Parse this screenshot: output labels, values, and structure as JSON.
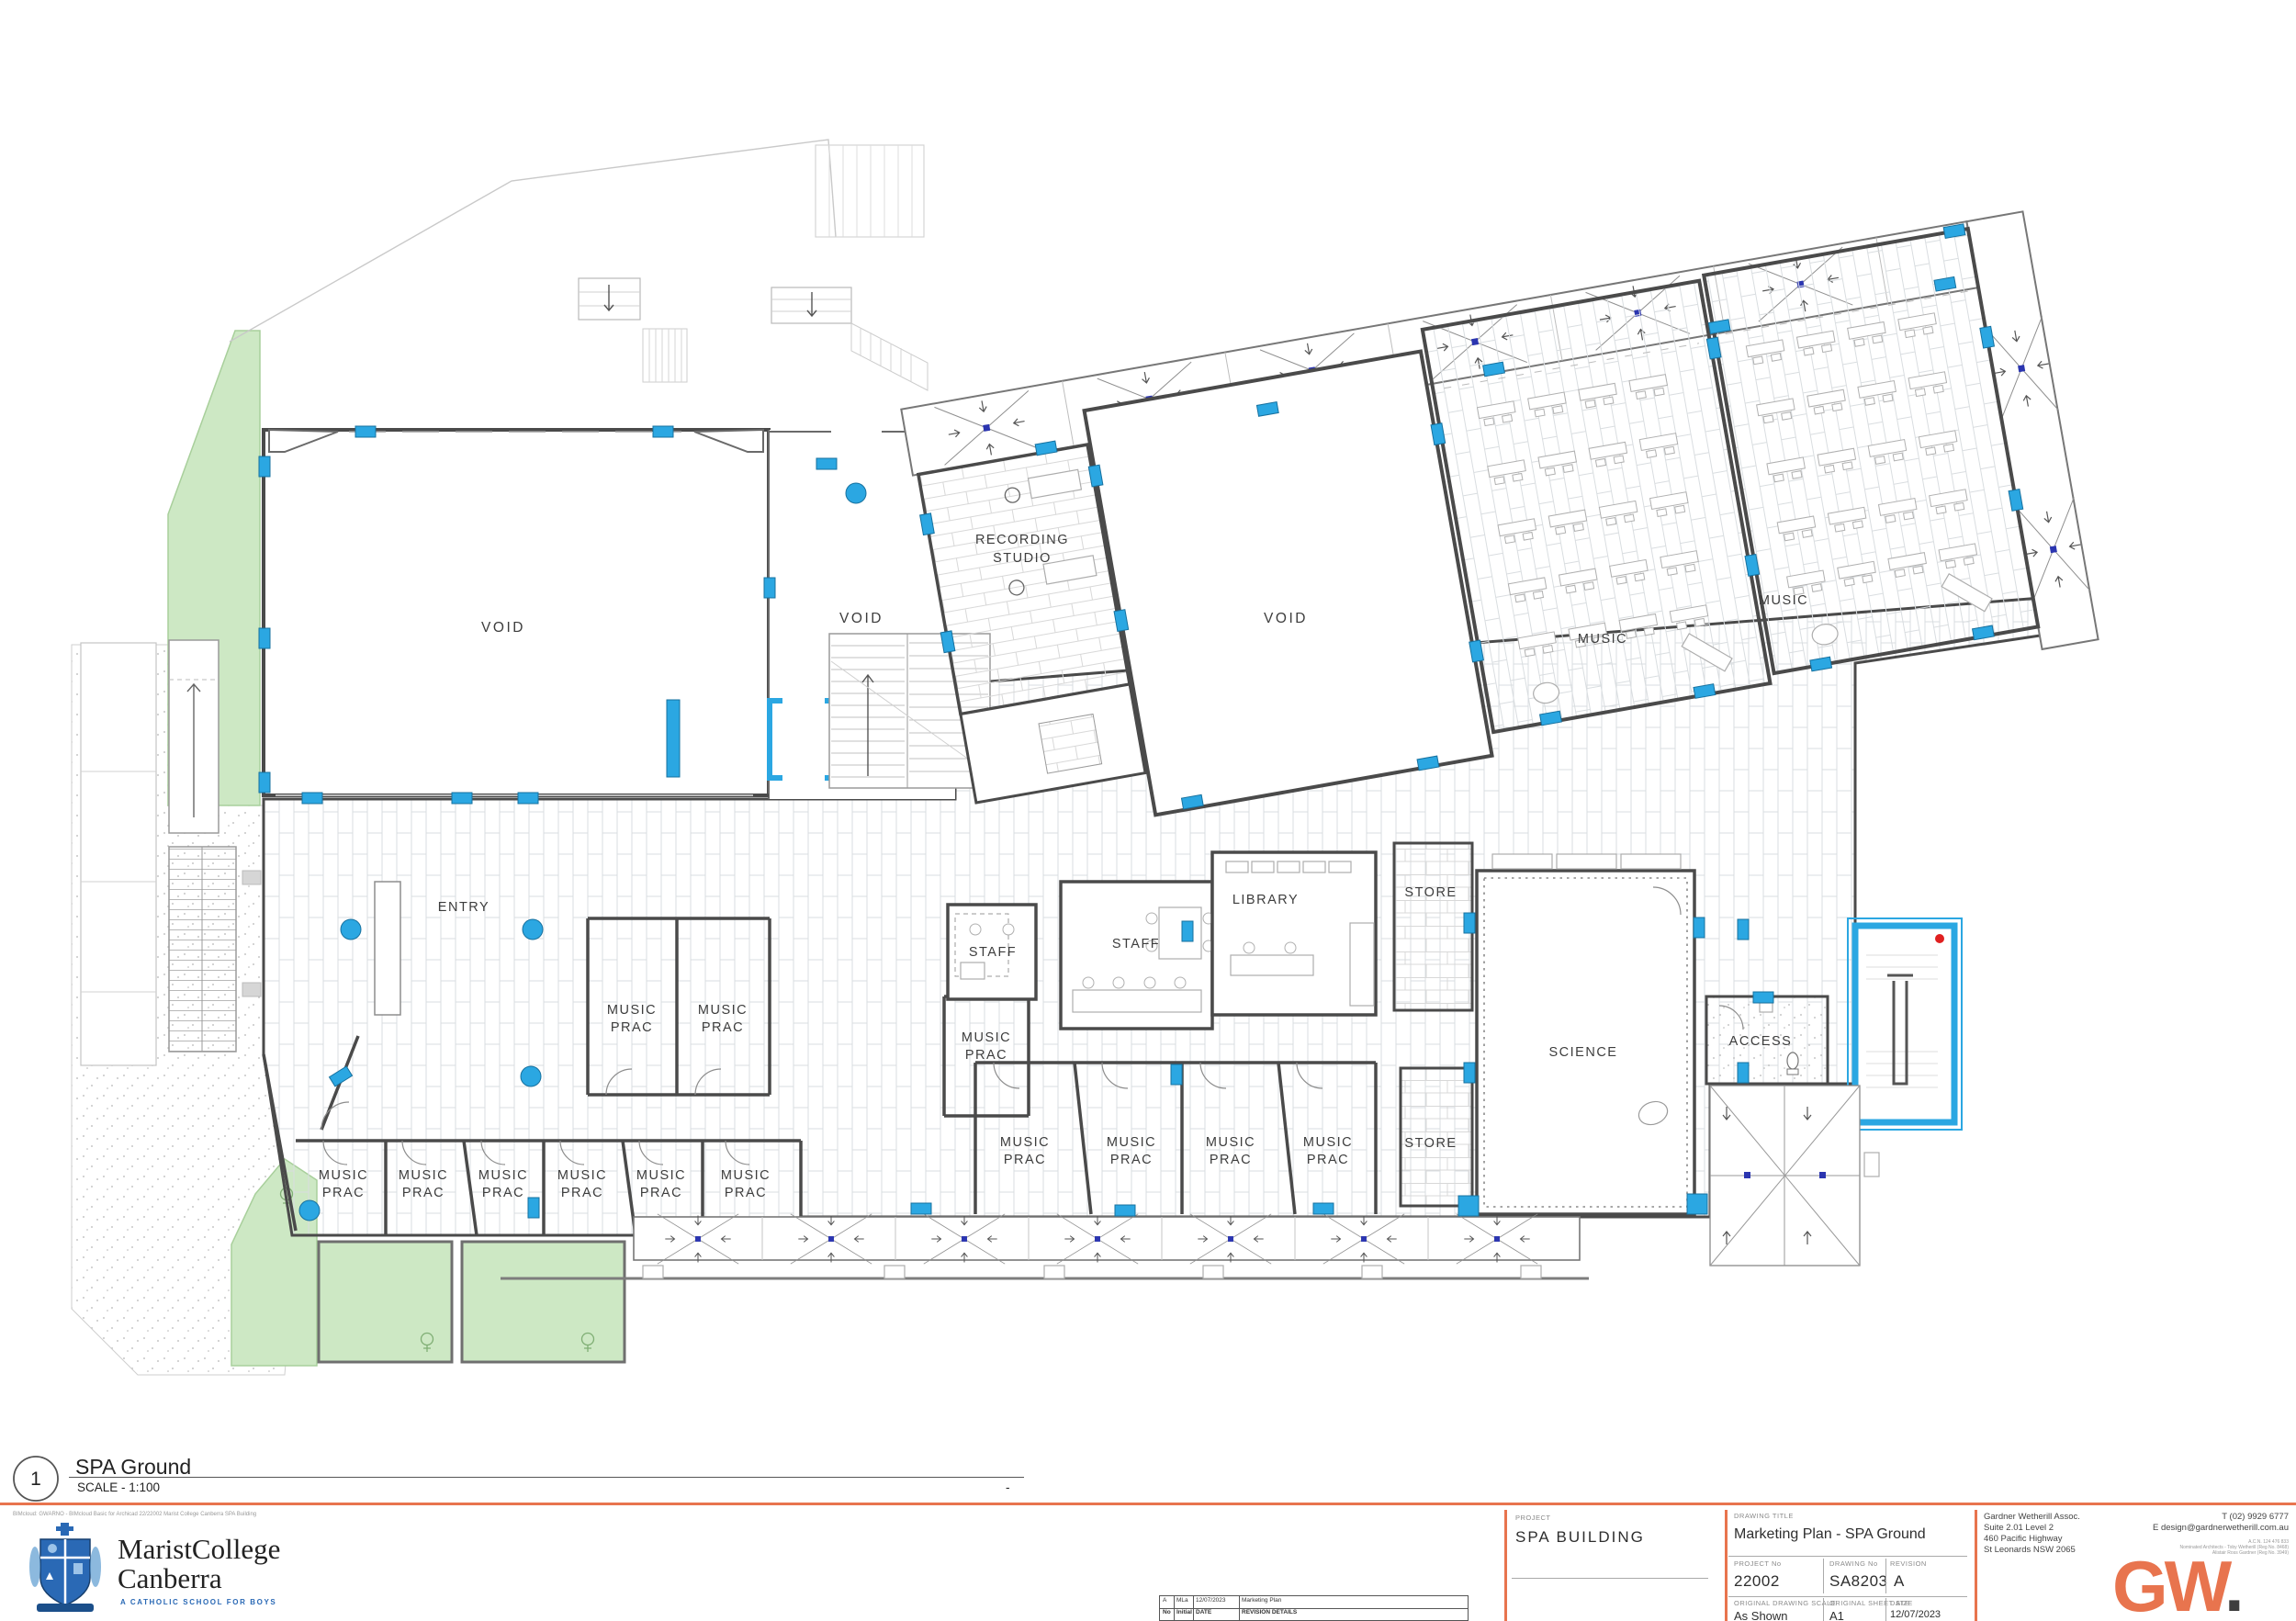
{
  "labels": {
    "void": "VOID",
    "entry": "ENTRY",
    "music": "MUSIC",
    "prac": "PRAC",
    "recording": "RECORDING",
    "studio": "STUDIO",
    "staff": "STAFF",
    "library": "LIBRARY",
    "store": "STORE",
    "science": "SCIENCE",
    "access": "ACCESS"
  },
  "ref": {
    "number": "1",
    "name": "SPA Ground",
    "scale": "SCALE - 1:100",
    "dash": "-"
  },
  "footer": {
    "note": "BIMcloud: GWARNO - BIMcloud Basic for Archicad 22/22002 Marist College Canberra SPA Building",
    "marist1": "MaristCollege",
    "marist2": "Canberra",
    "tagline": "A CATHOLIC SCHOOL FOR BOYS"
  },
  "revision": {
    "r_no": "A",
    "r_init": "MLa",
    "r_date": "12/07/2023",
    "r_details": "Marketing Plan",
    "h_no": "No",
    "h_init": "Initial",
    "h_date": "DATE",
    "h_details": "REVISION DETAILS"
  },
  "project": {
    "label": "PROJECT",
    "name": "SPA BUILDING"
  },
  "title_block": {
    "title_label": "DRAWING TITLE",
    "title": "Marketing Plan - SPA Ground",
    "project_no_label": "PROJECT No",
    "project_no": "22002",
    "drawing_no_label": "DRAWING No",
    "drawing_no": "SA8203",
    "revision_label": "REVISION",
    "revision": "A",
    "scale_label": "ORIGINAL DRAWING SCALE",
    "scale": "As Shown",
    "sheet_label": "ORIGINAL SHEET SIZE",
    "sheet": "A1",
    "date_label": "DATE",
    "date": "12/07/2023"
  },
  "firm": {
    "name": "Gardner Wetherill Assoc.",
    "addr1": "Suite 2.01 Level 2",
    "addr2": "460 Pacific Highway",
    "addr3": "St Leonards NSW 2065",
    "phone": "T (02) 9929 6777",
    "email": "E design@gardnerwetherill.com.au",
    "acn": "A.C.N. 124 476 833",
    "arch1": "Nominated Architects - Toby Wetherill (Reg No. 8468)",
    "arch2": "Alistair Ross Gardner (Reg No. 3949)",
    "logo": "GW",
    "logo_dot": "."
  },
  "colors": {
    "accent_orange": "#E8744E",
    "highlight_blue": "#2BA7E2",
    "landscape_green": "#CDE8C4",
    "navy_node": "#2B35B0",
    "crest_blue": "#2A69B5",
    "hydrant_red": "#E02020"
  }
}
